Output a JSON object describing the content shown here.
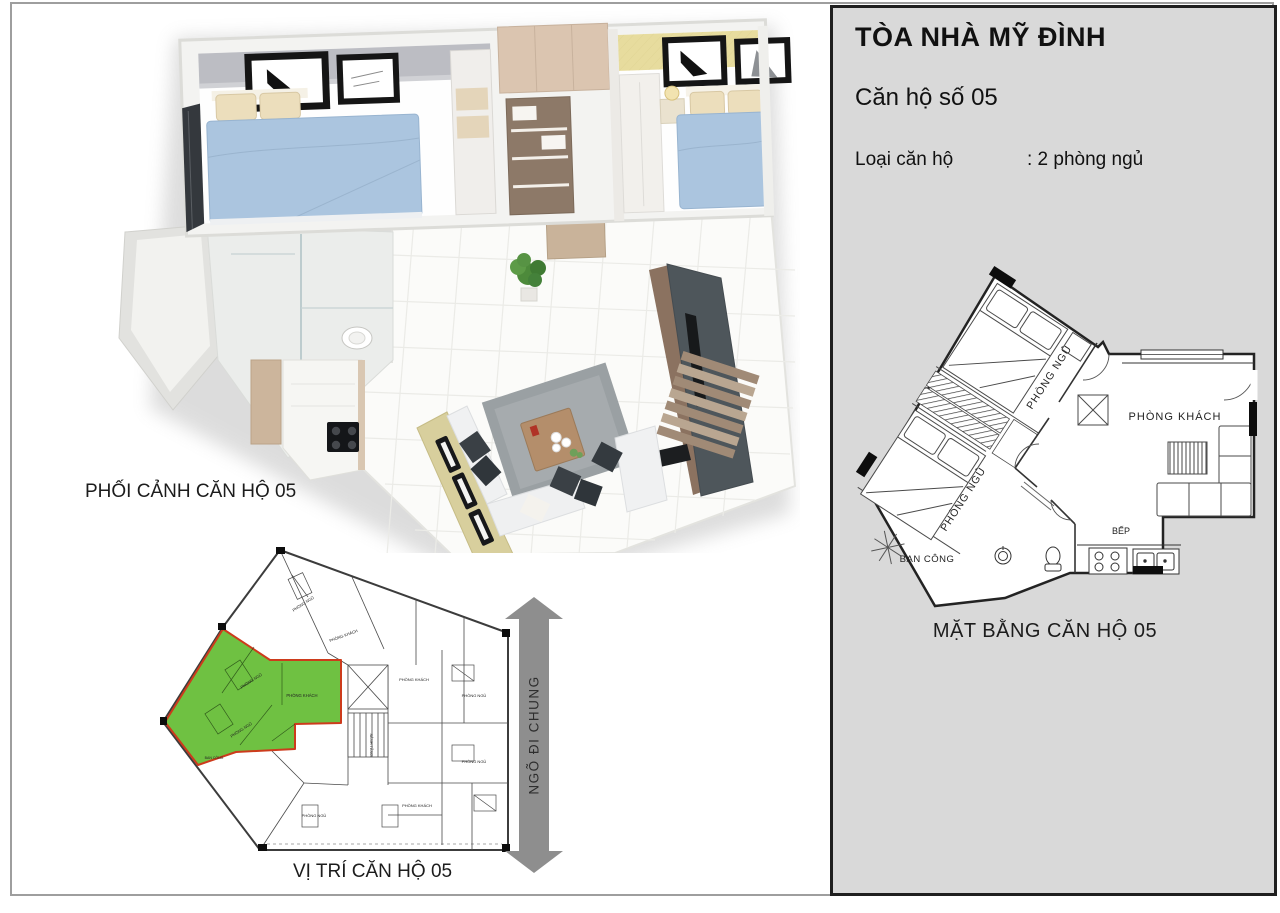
{
  "page": {
    "frame_color": "#9e9e9e"
  },
  "left_section": {
    "render_caption": "PHỐI CẢNH CĂN HỘ 05",
    "siteplan_caption": "VỊ TRÍ CĂN HỘ 05",
    "alley_arrow_label": "NGÕ ĐI CHUNG",
    "highlight_color": "#6fc142",
    "highlight_outline_color": "#cd3b1c",
    "siteplan_labels": [
      "PHÒNG NGỦ",
      "PHÒNG KHÁCH",
      "BAN CÔNG",
      "SẢNH TẦNG"
    ]
  },
  "panel": {
    "bg_color": "#d9d9d9",
    "title": "TÒA NHÀ MỸ ĐÌNH",
    "subtitle": "Căn hộ số 05",
    "type_label": "Loại căn hộ",
    "type_value": ": 2 phòng ngủ",
    "plan_caption": "MẶT BẰNG CĂN HỘ 05",
    "plan_labels": {
      "bedroom1": "PHÒNG NGỦ",
      "bedroom2": "PHÒNG NGỦ",
      "living": "PHÒNG KHÁCH",
      "kitchen": "BẾP",
      "balcony": "BAN CÔNG"
    }
  }
}
